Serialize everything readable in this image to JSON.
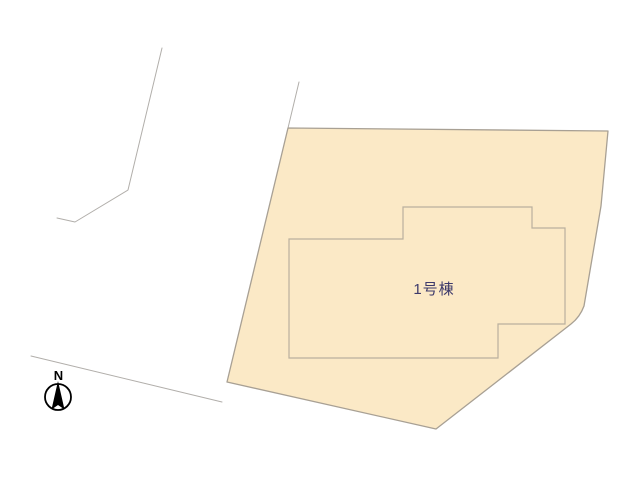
{
  "plan": {
    "background_color": "#ffffff",
    "lot": {
      "name": "lot-parcel",
      "fill": "#fbe9c6",
      "stroke": "#a8a094",
      "path": "M 288 128 L 608 131 L 601 206 L 584 306 Q 580 317 571 324 L 436 429 L 227 382 Z"
    },
    "building": {
      "label": "1号棟",
      "label_color": "#3d3a6b",
      "fill": "#fbe9c6",
      "stroke": "#b9b09e",
      "path": "M 289 239 L 403 239 L 403 207 L 532 207 L 532 228 L 565 228 L 565 324 L 498 324 L 498 358 L 289 358 Z",
      "label_x": "434",
      "label_y": "294"
    },
    "boundary_lines": {
      "stroke": "#b1aeaa",
      "paths": {
        "left_parcel": "M 162 48 L 128 190 L 75 222 L 57 218",
        "upper_right": "M 299 82 L 288 128",
        "lower_left": "M 31 356 L 222 402"
      }
    },
    "compass": {
      "label": "N",
      "color": "#000000",
      "circle": {
        "cx": "58",
        "cy": "397",
        "r": "13"
      },
      "needle_points": "58,381 51.5,409.5 58,405 64.5,409.5",
      "label_x": "58.5",
      "label_y": "380"
    }
  }
}
